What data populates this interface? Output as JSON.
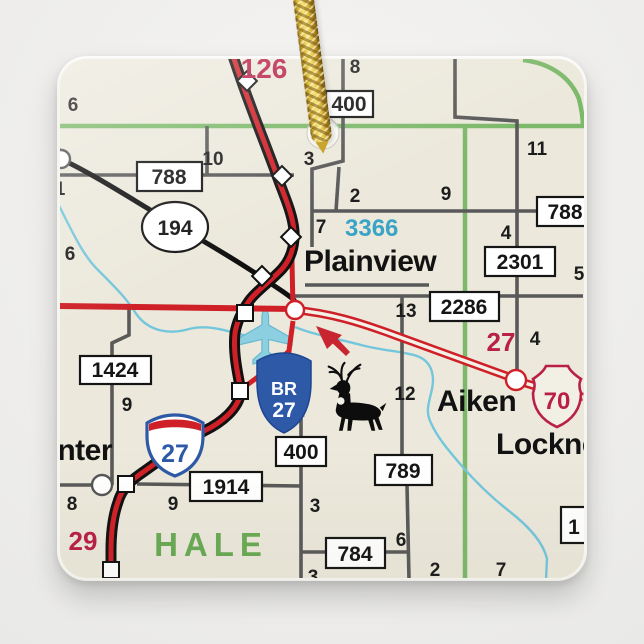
{
  "colors": {
    "map_background": "#ece9dc",
    "interstate_red": "#cf2027",
    "route_label_crimson": "#b82046",
    "county_line_green": "#7cb96a",
    "county_label_green": "#69aa54",
    "fm_route_teal": "#3aa4c6",
    "stream_blue": "#74c6dc",
    "road_gray": "#595959",
    "shield_blue": "#2e59a6",
    "cord_gold": "#d9b63a"
  },
  "map": {
    "county": "HALE",
    "towns": {
      "plainview": "Plainview",
      "aiken": "Aiken",
      "lockney_partial": "Lockne",
      "center_partial": "nter"
    },
    "route_boxes": {
      "box_400_top": "400",
      "box_788_left": "788",
      "oval_194": "194",
      "box_788_right": "788",
      "box_2301": "2301",
      "box_2286": "2286",
      "box_1424": "1424",
      "box_1914": "1914",
      "box_400_low": "400",
      "box_789": "789",
      "box_784": "784",
      "box_partial_right": "1"
    },
    "shields": {
      "interstate_27": "27",
      "business_route_line1": "BR",
      "business_route_line2": "27",
      "us_70": "70"
    },
    "red_route_labels": {
      "label_126": "126",
      "label_27": "27",
      "label_29": "29"
    },
    "teal_route_labels": {
      "label_3366": "3366"
    },
    "mile_markers": [
      "6",
      "8",
      "10",
      "3",
      "11",
      "2",
      "9",
      "7",
      "4",
      "5",
      "13",
      "4",
      "12",
      "9",
      "6",
      "1",
      "8",
      "9",
      "3",
      "6",
      "2",
      "7",
      "3"
    ]
  }
}
